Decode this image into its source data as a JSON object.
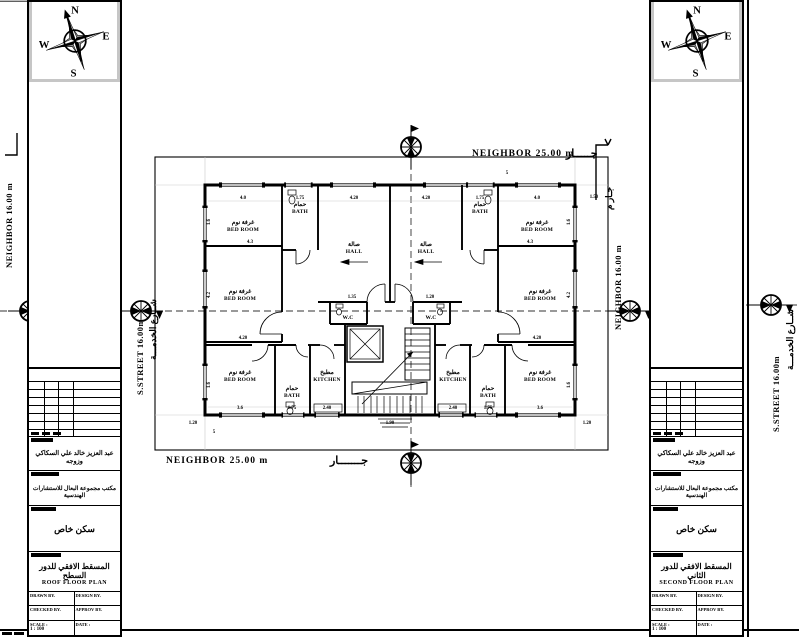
{
  "compass": {
    "n": "N",
    "e": "E",
    "s": "S",
    "w": "W"
  },
  "boundaries": {
    "top": {
      "en": "NEIGHBOR  25.00  m",
      "ar": "جـــــار"
    },
    "bottom": {
      "en": "NEIGHBOR  25.00  m",
      "ar": "جـــــــار"
    },
    "left_en": "S.STREET  16.00m",
    "left_ar": "شــارع الخدمـــة",
    "right_en": "NEIGHBOR  16.00  m",
    "right_ar": "جـار  م",
    "far_left_en": "NEIGHBOR  16.00  m",
    "far_right_en": "S.STREET  16.00m",
    "far_right_ar": "شــارع الخدمـــة"
  },
  "plan": {
    "rooms": [
      {
        "ar": "غرفة نوم",
        "en": "BED ROOM",
        "x": 243,
        "y": 228
      },
      {
        "ar": "حمام",
        "en": "BATH",
        "x": 300,
        "y": 210
      },
      {
        "ar": "صالة",
        "en": "HALL",
        "x": 354,
        "y": 250
      },
      {
        "ar": "صالة",
        "en": "HALL",
        "x": 426,
        "y": 250
      },
      {
        "ar": "حمام",
        "en": "BATH",
        "x": 480,
        "y": 210
      },
      {
        "ar": "غرفة نوم",
        "en": "BED ROOM",
        "x": 537,
        "y": 228
      },
      {
        "ar": "غرفة نوم",
        "en": "BED ROOM",
        "x": 240,
        "y": 297
      },
      {
        "ar": "غرفة نوم",
        "en": "BED ROOM",
        "x": 540,
        "y": 297
      },
      {
        "ar": "",
        "en": "W.C",
        "x": 348,
        "y": 316
      },
      {
        "ar": "",
        "en": "W.C",
        "x": 431,
        "y": 316
      },
      {
        "ar": "غرفة نوم",
        "en": "BED ROOM",
        "x": 240,
        "y": 378
      },
      {
        "ar": "حمام",
        "en": "BATH",
        "x": 292,
        "y": 394
      },
      {
        "ar": "مطبخ",
        "en": "KITCHEN",
        "x": 327,
        "y": 378
      },
      {
        "ar": "مطبخ",
        "en": "KITCHEN",
        "x": 453,
        "y": 378
      },
      {
        "ar": "حمام",
        "en": "BATH",
        "x": 488,
        "y": 394
      },
      {
        "ar": "غرفة نوم",
        "en": "BED ROOM",
        "x": 540,
        "y": 378
      }
    ],
    "dims": [
      {
        "v": "4.0",
        "x": 243,
        "y": 199
      },
      {
        "v": "1.75",
        "x": 300,
        "y": 199
      },
      {
        "v": "4.20",
        "x": 354,
        "y": 199
      },
      {
        "v": "4.20",
        "x": 426,
        "y": 199
      },
      {
        "v": "1.75",
        "x": 480,
        "y": 199
      },
      {
        "v": "4.0",
        "x": 537,
        "y": 199
      },
      {
        "v": "4.3",
        "x": 250,
        "y": 243
      },
      {
        "v": "4.3",
        "x": 530,
        "y": 243
      },
      {
        "v": "4.20",
        "x": 243,
        "y": 339
      },
      {
        "v": "4.20",
        "x": 537,
        "y": 339
      },
      {
        "v": "1.35",
        "x": 352,
        "y": 298
      },
      {
        "v": "1.20",
        "x": 430,
        "y": 298
      },
      {
        "v": "3.6",
        "x": 240,
        "y": 409
      },
      {
        "v": "1.75",
        "x": 292,
        "y": 409
      },
      {
        "v": "2.40",
        "x": 327,
        "y": 409
      },
      {
        "v": "1.90",
        "x": 390,
        "y": 424
      },
      {
        "v": "2.40",
        "x": 453,
        "y": 409
      },
      {
        "v": "1.75",
        "x": 488,
        "y": 409
      },
      {
        "v": "3.6",
        "x": 540,
        "y": 409
      },
      {
        "v": "1.20",
        "x": 193,
        "y": 424
      },
      {
        "v": "1.20",
        "x": 587,
        "y": 424
      },
      {
        "v": "1.50",
        "x": 594,
        "y": 198
      },
      {
        "v": "5",
        "x": 507,
        "y": 174
      },
      {
        "v": "5",
        "x": 214,
        "y": 433
      },
      {
        "v": "1.6",
        "x": 210,
        "y": 222,
        "rot": -90
      },
      {
        "v": "4.2",
        "x": 210,
        "y": 295,
        "rot": -90
      },
      {
        "v": "1.6",
        "x": 210,
        "y": 385,
        "rot": -90
      },
      {
        "v": "1.6",
        "x": 570,
        "y": 222,
        "rot": -90
      },
      {
        "v": "4.2",
        "x": 570,
        "y": 295,
        "rot": -90
      },
      {
        "v": "1.6",
        "x": 570,
        "y": 385,
        "rot": -90
      }
    ]
  },
  "title_blocks": {
    "labels": {
      "owner": "OWNER .",
      "designed": "DESIGNED .",
      "project": "PROJECT .",
      "dwg": "DWG.TITLE .",
      "drawn": "DRAWN BY.",
      "design": "DESIGN BY.",
      "checked": "CHECKED BY.",
      "approved": "APPROV BY.",
      "scale": "SCALE :",
      "scale_value": "1 : 100",
      "date": "DATE :"
    },
    "owner_ar": "عبد العزيز خالد علي السكاكي وزوجه",
    "designed_ar": "مكتب مجموعة البعال للاستشارات الهندسية",
    "project_ar": "سكن خاص",
    "left": {
      "dwg_ar": "المسقط الافقي للدور السطح",
      "dwg_en": "ROOF  FLOOR  PLAN"
    },
    "right": {
      "dwg_ar": "المسقط الافقي للدور الثاني",
      "dwg_en": "SECOND  FLOOR  PLAN"
    }
  }
}
